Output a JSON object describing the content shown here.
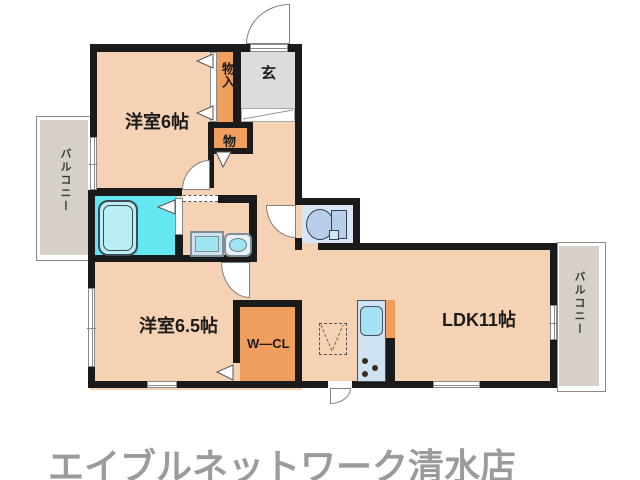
{
  "rooms": {
    "bedroom1": "洋室6帖",
    "bedroom2": "洋室6.5帖",
    "ldk": "LDK11帖",
    "entrance": "玄",
    "closet_tall": "物入",
    "closet_small": "物",
    "walkin_closet": "W―CL",
    "balcony_left": "バルコニー",
    "balcony_right": "バルコニー"
  },
  "footer": {
    "brand": "エイブルネットワーク清水店"
  },
  "colors": {
    "floor": "#f6d2b4",
    "storage_orange": "#ef9e5e",
    "entrance_floor": "#dcdcdc",
    "bath_floor": "#63e8f1",
    "toilet_floor": "#d6e6f5",
    "balcony": "#d6d0c8",
    "wall": "#1a1a1a",
    "brand_text": "#9b9b9b"
  }
}
